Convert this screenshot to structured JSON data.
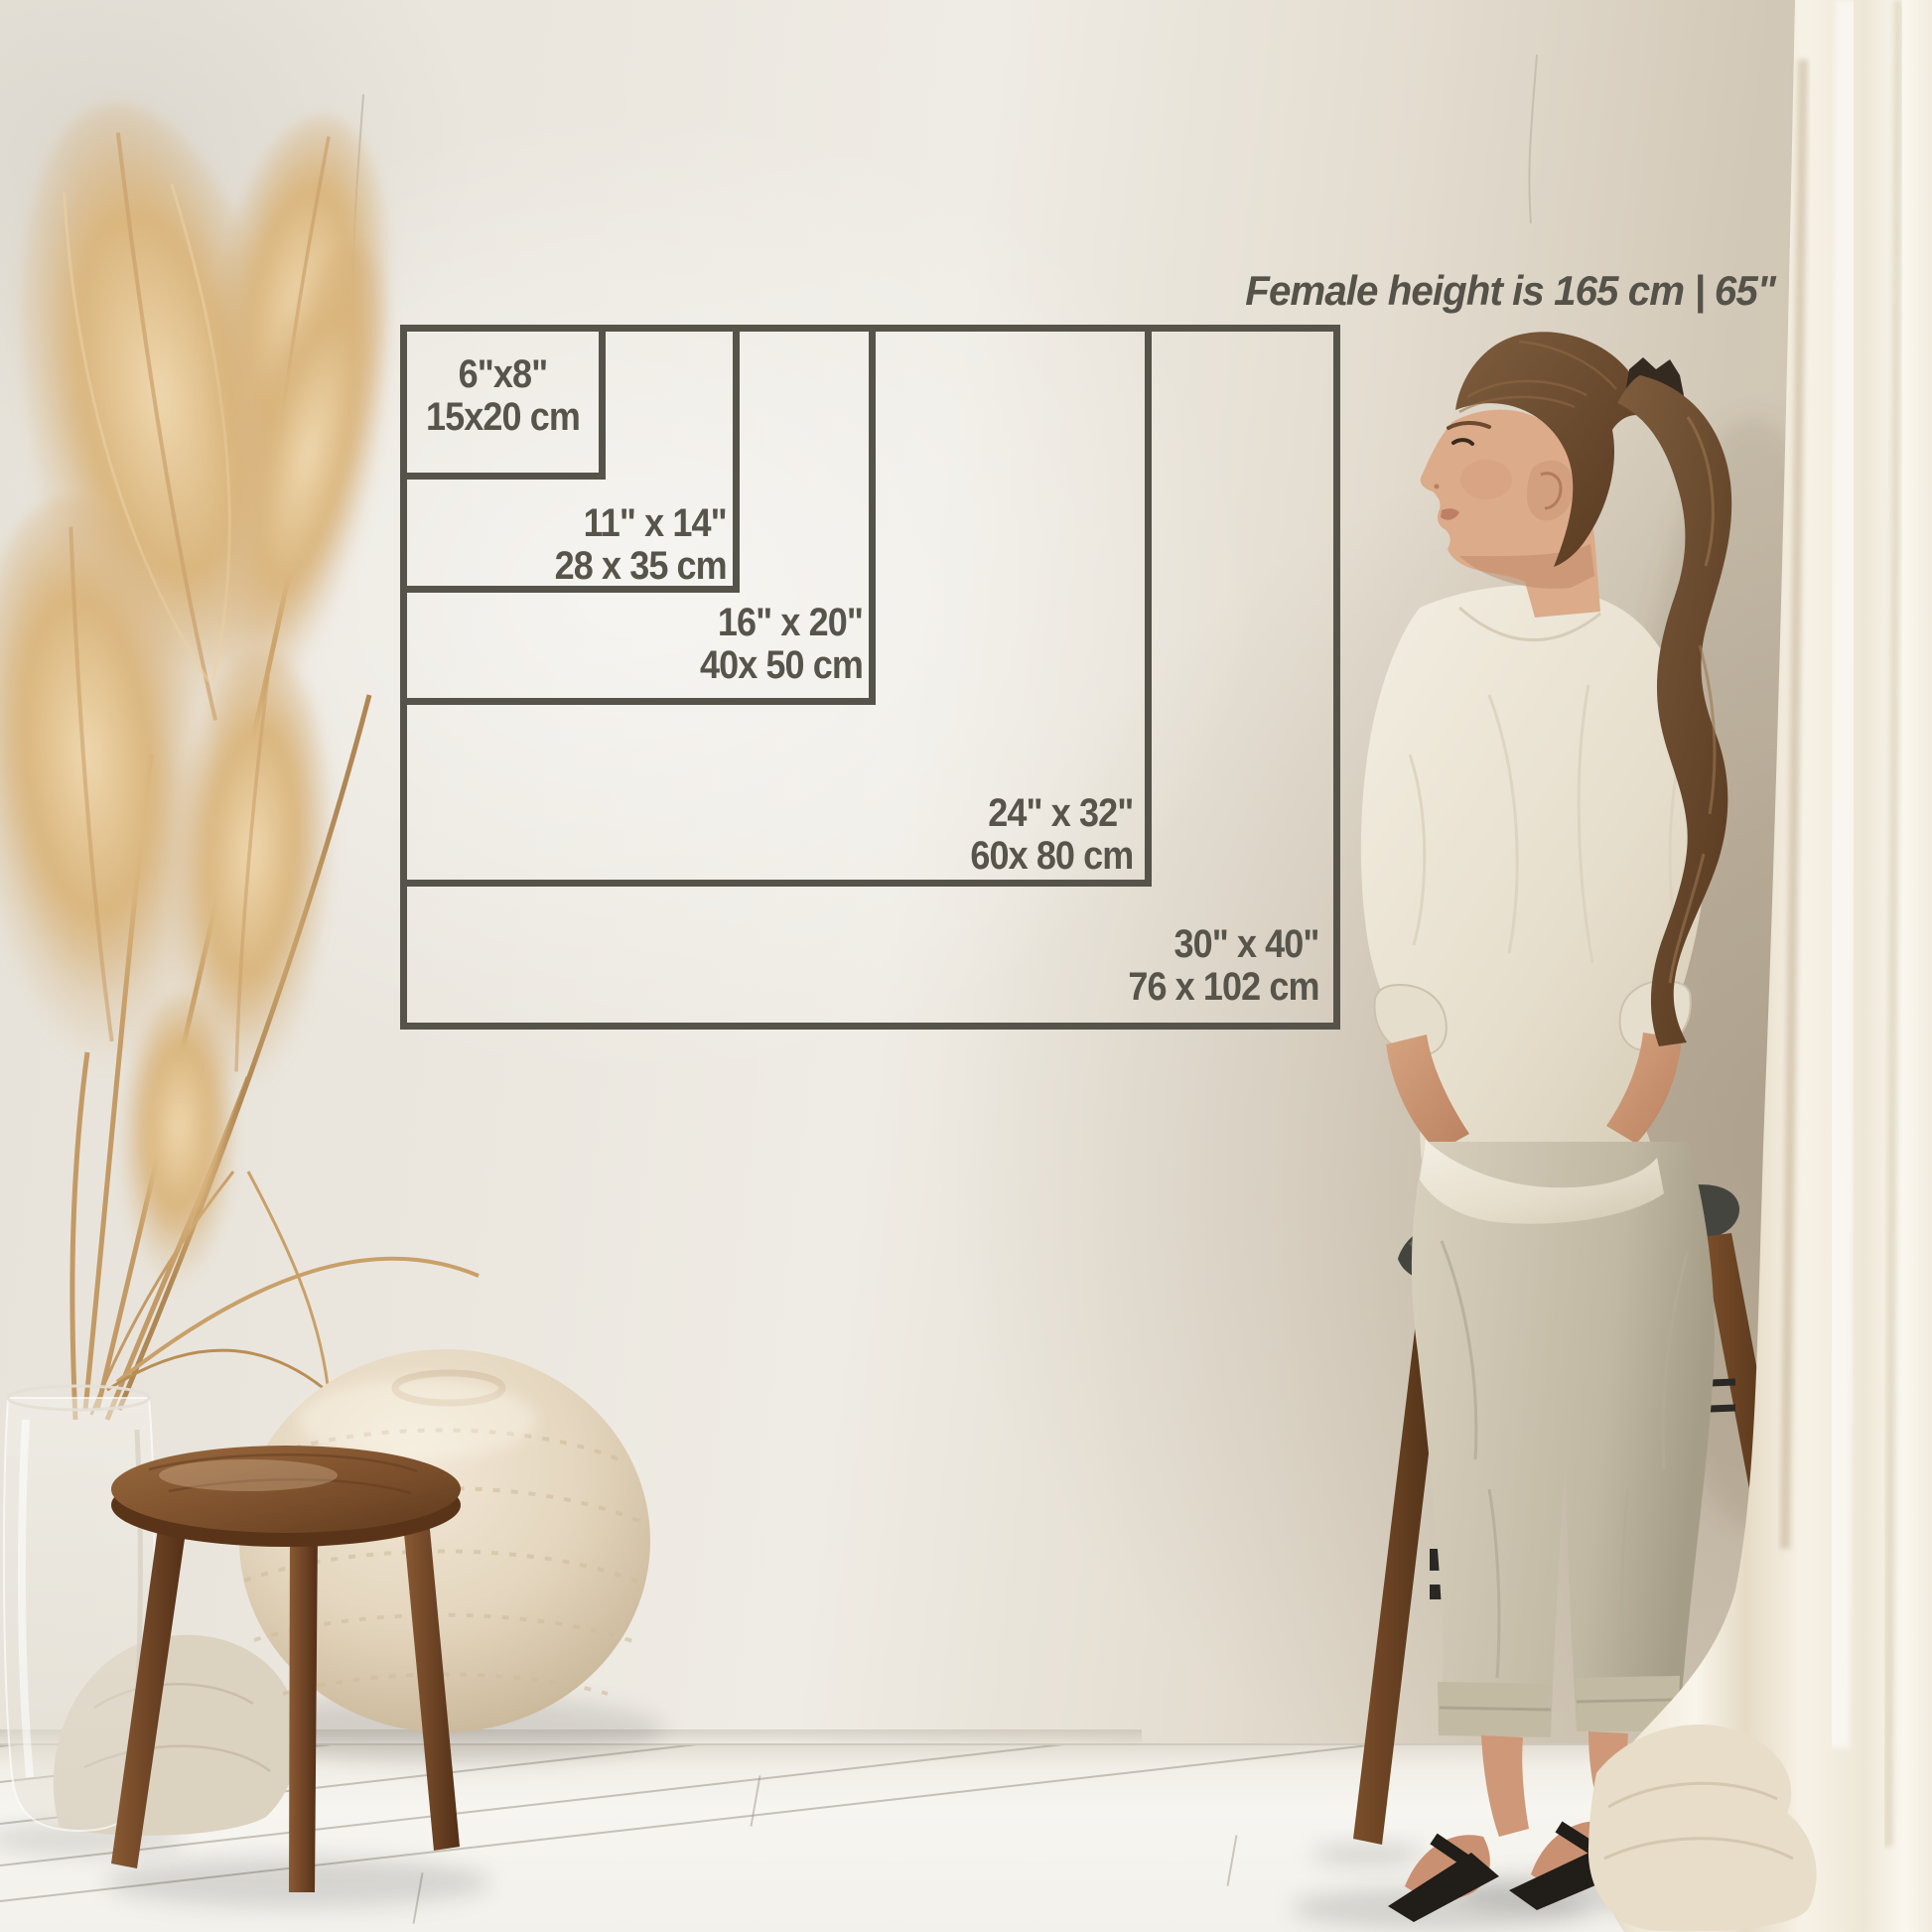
{
  "header": {
    "text": "Female height is 165 cm | 65\""
  },
  "size_chart": {
    "sizes": [
      {
        "id": "6x8",
        "inches": "6\"x8\"",
        "cm": "15x20 cm"
      },
      {
        "id": "11x14",
        "inches": "11\" x 14\"",
        "cm": "28 x 35 cm"
      },
      {
        "id": "16x20",
        "inches": "16\" x 20\"",
        "cm": "40x 50 cm"
      },
      {
        "id": "24x32",
        "inches": "24\" x 32\"",
        "cm": "60x 80 cm"
      },
      {
        "id": "30x40",
        "inches": "30\" x 40\"",
        "cm": "76 x 102 cm"
      }
    ],
    "line_color": "#56534a",
    "label_text_color": "#57544b",
    "header_text_color": "#55524a"
  }
}
